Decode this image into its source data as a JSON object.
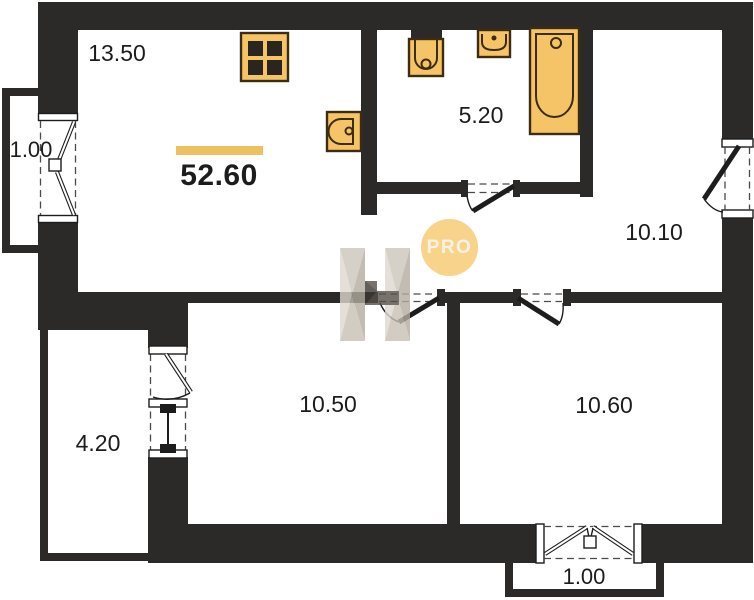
{
  "plan": {
    "total_area": "52.60",
    "watermark_badge": "PRO",
    "rooms": [
      {
        "name": "kitchen-living-room",
        "area": "13.50"
      },
      {
        "name": "bathroom",
        "area": "5.20"
      },
      {
        "name": "room-top-right",
        "area": "10.10"
      },
      {
        "name": "room-bottom-middle",
        "area": "10.50"
      },
      {
        "name": "room-bottom-right",
        "area": "10.60"
      },
      {
        "name": "balcony-left",
        "area": "1.00"
      },
      {
        "name": "balcony-bottom-left",
        "area": "4.20"
      },
      {
        "name": "balcony-bottom",
        "area": "1.00"
      }
    ]
  },
  "colors": {
    "wall": "#2b2a28",
    "accent": "#efc05f",
    "fixture": "#f5c467",
    "fixture-stroke": "#3d2b12",
    "badge": "#f7d48a",
    "badge-text": "#f6f1e5",
    "text": "#1c1c1c",
    "dash": "#4a4a4a"
  }
}
